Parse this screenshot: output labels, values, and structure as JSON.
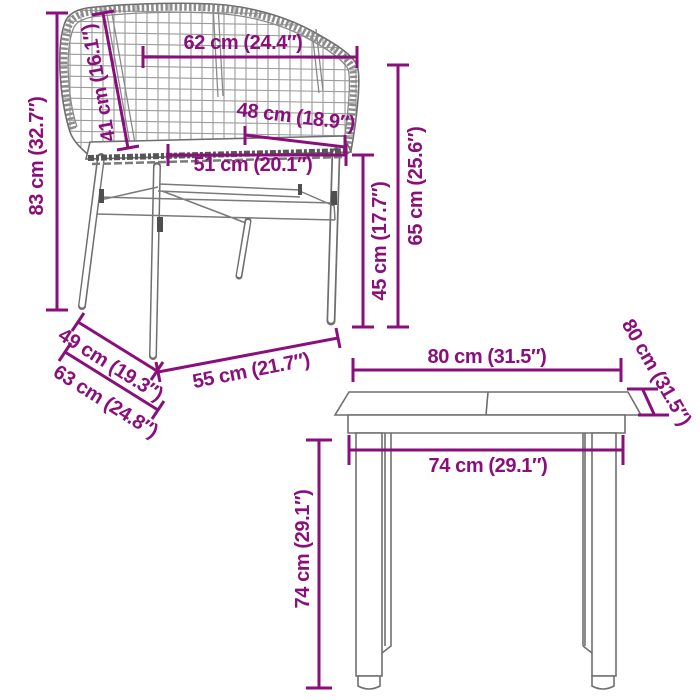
{
  "colors": {
    "dimension_accent": "#8A0F7B",
    "furniture_outline": "#6f6f6f",
    "rattan_grid": "#9b9b9b",
    "background": "#ffffff"
  },
  "chair": {
    "dimensions": [
      {
        "name": "total-height",
        "label": "83 cm (32.7″)"
      },
      {
        "name": "backrest-height",
        "label": "41 cm (16.1″)"
      },
      {
        "name": "backrest-width",
        "label": "62 cm (24.4″)"
      },
      {
        "name": "seat-depth",
        "label": "48 cm (18.9″)"
      },
      {
        "name": "seat-width",
        "label": "51 cm (20.1″)"
      },
      {
        "name": "seat-height",
        "label": "45 cm (17.7″)"
      },
      {
        "name": "armrest-height",
        "label": "65 cm (25.6″)"
      },
      {
        "name": "upper-depth",
        "label": "49 cm (19.3″)"
      },
      {
        "name": "base-depth",
        "label": "63 cm (24.8″)"
      },
      {
        "name": "base-width",
        "label": "55 cm (21.7″)"
      }
    ]
  },
  "table": {
    "dimensions": [
      {
        "name": "top-width",
        "label": "80 cm (31.5″)"
      },
      {
        "name": "top-depth",
        "label": "80 cm (31.5″)"
      },
      {
        "name": "leg-span-width",
        "label": "74 cm (29.1″)"
      },
      {
        "name": "height",
        "label": "74 cm (29.1″)"
      }
    ]
  }
}
